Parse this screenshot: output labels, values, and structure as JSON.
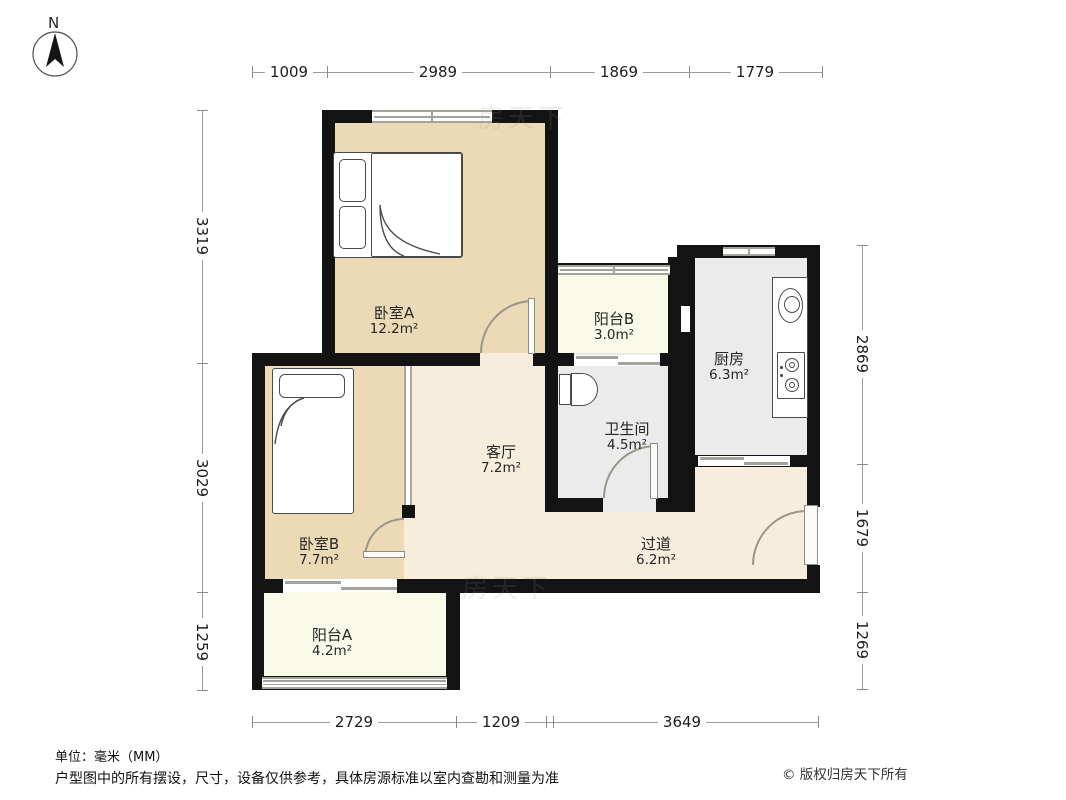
{
  "compass": {
    "north_label": "N"
  },
  "rooms": [
    {
      "id": "bedroom-a",
      "name": "卧室A",
      "area": "12.2m²"
    },
    {
      "id": "balcony-b",
      "name": "阳台B",
      "area": "3.0m²"
    },
    {
      "id": "kitchen",
      "name": "厨房",
      "area": "6.3m²"
    },
    {
      "id": "bathroom",
      "name": "卫生间",
      "area": "4.5m²"
    },
    {
      "id": "living-room",
      "name": "客厅",
      "area": "7.2m²"
    },
    {
      "id": "bedroom-b",
      "name": "卧室B",
      "area": "7.7m²"
    },
    {
      "id": "hallway",
      "name": "过道",
      "area": "6.2m²"
    },
    {
      "id": "balcony-a",
      "name": "阳台A",
      "area": "4.2m²"
    }
  ],
  "dimensions": {
    "top": [
      "1009",
      "2989",
      "1869",
      "1779"
    ],
    "left": [
      "3319",
      "3029",
      "1259"
    ],
    "right": [
      "2869",
      "1679",
      "1269"
    ],
    "bottom": [
      "2729",
      "1209",
      "3649"
    ]
  },
  "footer": {
    "units": "单位：毫米（MM）",
    "disclaimer": "户型图中的所有摆设，尺寸，设备仅供参考，具体房源标准以室内查勘和测量为准",
    "copyright": "© 版权归房天下所有"
  },
  "watermark": "房天下",
  "colors": {
    "wall": "#131313",
    "bedroom_fill": "#ecd9b6",
    "living_fill": "#f6eddc",
    "balcony_fill": "#fafae9",
    "kitchen_bath_fill": "#ebebeb",
    "dimension_line": "#9b9b9b"
  }
}
